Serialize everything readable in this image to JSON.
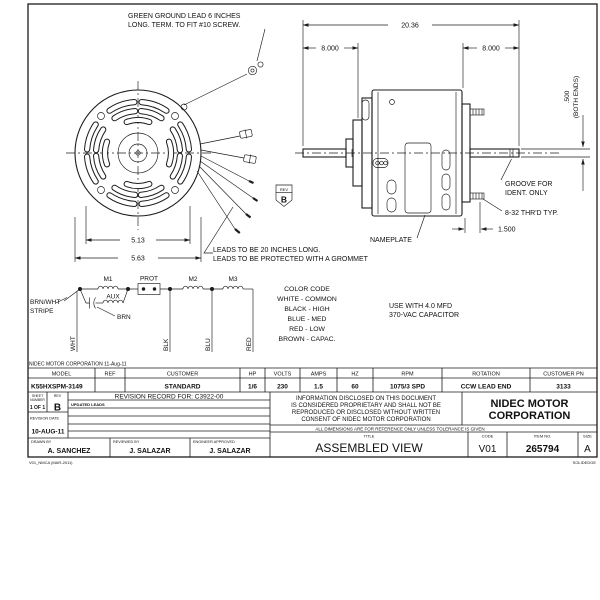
{
  "sheet": {
    "footer_note": "NIDEC MOTOR CORPORATION 11-Aug-11",
    "form_id": "V01_NMCA (MAR-2011)",
    "cad_note": "SOLIDEDGE"
  },
  "notes": {
    "ground_lead_1": "GREEN GROUND LEAD 6 INCHES",
    "ground_lead_2": "LONG. TERM. TO FIT #10 SCREW.",
    "leads_1": "LEADS TO BE 20 INCHES LONG.",
    "leads_2": "LEADS TO BE PROTECTED WITH A GROMMET",
    "groove_1": "GROOVE FOR",
    "groove_2": "IDENT. ONLY",
    "thread": "8-32 THR'D TYP.",
    "nameplate": "NAMEPLATE",
    "capacitor_1": "USE WITH 4.0 MFD",
    "capacitor_2": "370-VAC CAPACITOR"
  },
  "dimensions": {
    "overall_length": "20.36",
    "shaft_left": "8.000",
    "shaft_right": "8.000",
    "shaft_dia": ".500",
    "shaft_dia_note": "(BOTH ENDS)",
    "stud_length": "1.500",
    "bolt_circle": "5.13",
    "shell_dia": "5.63"
  },
  "rev_flag": {
    "label": "REV",
    "value": "B"
  },
  "schematic": {
    "m1": "M1",
    "prot": "PROT",
    "m2": "M2",
    "m3": "M3",
    "aux": "AUX",
    "brn": "BRN",
    "brn_wht_1": "BRN/WHT",
    "brn_wht_2": "STRIPE",
    "wht": "WHT",
    "blk": "BLK",
    "blu": "BLU",
    "red": "RED",
    "color_code": [
      "COLOR CODE",
      "WHITE - COMMON",
      "BLACK - HIGH",
      "BLUE - MED",
      "RED - LOW",
      "BROWN - CAPAC."
    ]
  },
  "spec_table": {
    "headers": [
      "MODEL",
      "REF",
      "CUSTOMER",
      "HP",
      "VOLTS",
      "AMPS",
      "HZ",
      "RPM",
      "ROTATION",
      "CUSTOMER PN"
    ],
    "values": [
      "K55HXSPM-3149",
      "",
      "STANDARD",
      "1/6",
      "230",
      "1.5",
      "60",
      "1075/3 SPD",
      "CCW LEAD END",
      "3133"
    ]
  },
  "title_block": {
    "sheet_label_1": "SHEET",
    "sheet_label_2": "NUMBER",
    "sheet_value": "1 OF 1",
    "rev_label": "REV",
    "rev_value": "B",
    "revision_record": "REVISION RECORD FOR: C3922-00",
    "revision_entry": "UPDATED LEADS",
    "revision_date_label": "REVISION DATE",
    "revision_date": "10-AUG-11",
    "drawn_label": "DRAWN BY",
    "drawn_by": "A. SANCHEZ",
    "reviewed_label": "REVIEWED BY",
    "reviewed_by": "J. SALAZAR",
    "approved_label": "ENGINEER APPROVED",
    "approved_by": "J. SALAZAR",
    "proprietary": [
      "INFORMATION DISCLOSED ON THIS DOCUMENT",
      "IS CONSIDERED PROPRIETARY AND SHALL NOT BE",
      "REPRODUCED OR DISCLOSED WITHOUT WRITTEN",
      "CONSENT OF NIDEC MOTOR CORPORATION"
    ],
    "company_1": "NIDEC MOTOR",
    "company_2": "CORPORATION",
    "tolerance_note": "ALL DIMENSIONS ARE FOR REFERENCE ONLY UNLESS TOLERANCE IS GIVEN",
    "title_label": "TITLE",
    "title": "ASSEMBLED VIEW",
    "code_label": "CODE",
    "code": "V01",
    "item_label": "ITEM NO.",
    "item_no": "265794",
    "size_label": "SIZE",
    "size": "A"
  }
}
